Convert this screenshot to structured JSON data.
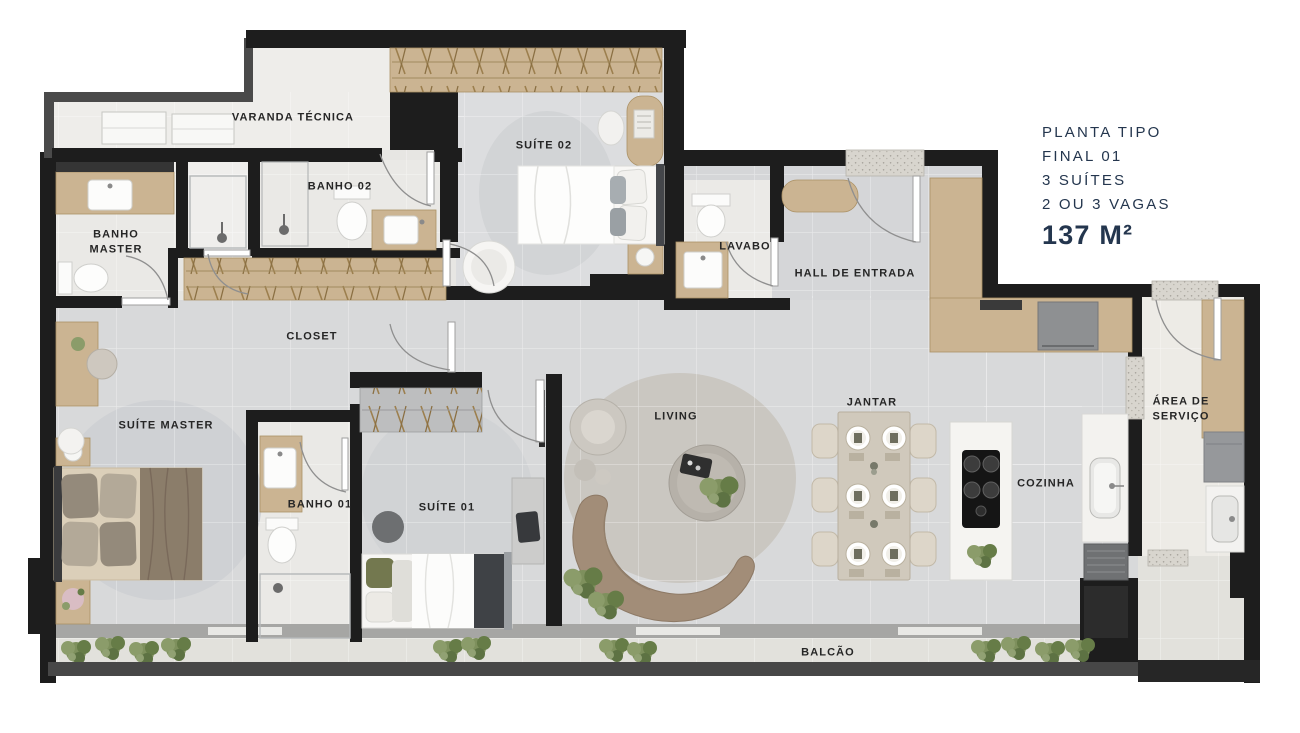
{
  "plan": {
    "kind": "apartment floor plan",
    "language": "pt-BR"
  },
  "title_block": {
    "line1": "PLANTA TIPO",
    "line2": "FINAL 01",
    "line3": "3 SUÍTES",
    "line4": "2 OU 3 VAGAS",
    "area": "137 M²"
  },
  "rooms": [
    {
      "id": "varanda-tecnica",
      "label": "VARANDA TÉCNICA"
    },
    {
      "id": "banho-02",
      "label": "BANHO 02"
    },
    {
      "id": "suite-02",
      "label": "SUÍTE 02"
    },
    {
      "id": "lavabo",
      "label": "LAVABO"
    },
    {
      "id": "hall-de-entrada",
      "label": "HALL DE ENTRADA"
    },
    {
      "id": "banho-master",
      "label": "BANHO\nMASTER"
    },
    {
      "id": "closet",
      "label": "CLOSET"
    },
    {
      "id": "suite-master",
      "label": "SUÍTE MASTER"
    },
    {
      "id": "banho-01",
      "label": "BANHO 01"
    },
    {
      "id": "suite-01",
      "label": "SUÍTE 01"
    },
    {
      "id": "living",
      "label": "LIVING"
    },
    {
      "id": "jantar",
      "label": "JANTAR"
    },
    {
      "id": "cozinha",
      "label": "COZINHA"
    },
    {
      "id": "area-de-servico",
      "label": "ÁREA DE\nSERVIÇO"
    },
    {
      "id": "balcao",
      "label": "BALCÃO"
    }
  ],
  "colors": {
    "title_text": "#24364E",
    "label_text": "#262626",
    "walls": "#1D1D1D",
    "wood": "#CBB492",
    "floor": "#D8D9DA",
    "bath_floor": "#EAE9E6",
    "rug": "#CFD1D4",
    "sofa": "#A28D78",
    "rail": "#474747",
    "plant": "#7E905D"
  }
}
